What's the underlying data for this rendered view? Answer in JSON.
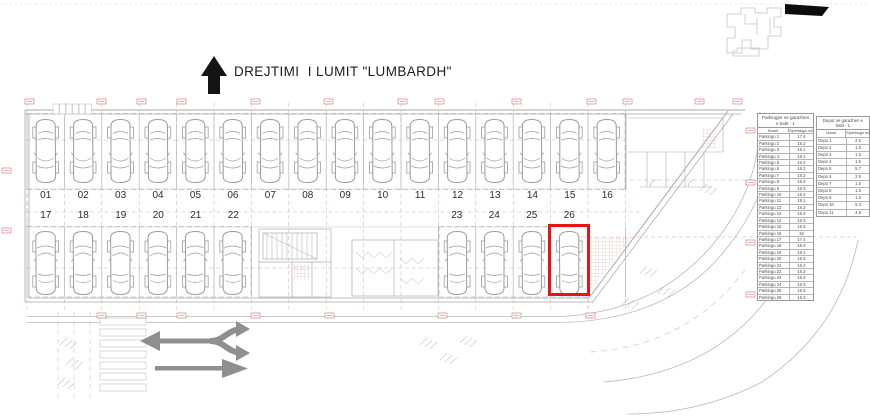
{
  "title": {
    "text": "DREJTIMI  I LUMIT \"LUMBARDH\""
  },
  "stalls": {
    "top_row": [
      "01",
      "02",
      "03",
      "04",
      "05",
      "06",
      "07",
      "08",
      "09",
      "10",
      "11",
      "12",
      "13",
      "14",
      "15",
      "16"
    ],
    "bottom_row_left": [
      "17",
      "18",
      "19",
      "20",
      "21",
      "22"
    ],
    "bottom_row_right": [
      "23",
      "24",
      "25",
      "26"
    ],
    "highlighted_stall": "26"
  },
  "parking_table": {
    "title": "Parkingjet ne garazhen e katit - 1",
    "columns": [
      "Numri",
      "Siperfaqja m2"
    ],
    "rows": [
      {
        "name": "Parkingu 1",
        "area": "17.4"
      },
      {
        "name": "Parkingu 2",
        "area": "16.3"
      },
      {
        "name": "Parkingu 3",
        "area": "19.1"
      },
      {
        "name": "Parkingu 4",
        "area": "19.1"
      },
      {
        "name": "Parkingu 5",
        "area": "16.3"
      },
      {
        "name": "Parkingu 6",
        "area": "16.3"
      },
      {
        "name": "Parkingu 7",
        "area": "16.3"
      },
      {
        "name": "Parkingu 8",
        "area": "16.3"
      },
      {
        "name": "Parkingu 9",
        "area": "16.3"
      },
      {
        "name": "Parkingu 10",
        "area": "16.3"
      },
      {
        "name": "Parkingu 11",
        "area": "19.1"
      },
      {
        "name": "Parkingu 12",
        "area": "16.3"
      },
      {
        "name": "Parkingu 13",
        "area": "16.3"
      },
      {
        "name": "Parkingu 14",
        "area": "16.3"
      },
      {
        "name": "Parkingu 15",
        "area": "16.3"
      },
      {
        "name": "Parkingu 16",
        "area": "18"
      },
      {
        "name": "Parkingu 17",
        "area": "17.4"
      },
      {
        "name": "Parkingu 18",
        "area": "16.3"
      },
      {
        "name": "Parkingu 19",
        "area": "19.1"
      },
      {
        "name": "Parkingu 20",
        "area": "16.3"
      },
      {
        "name": "Parkingu 21",
        "area": "16.3"
      },
      {
        "name": "Parkingu 22",
        "area": "16.3"
      },
      {
        "name": "Parkingu 23",
        "area": "16.3"
      },
      {
        "name": "Parkingu 24",
        "area": "16.3"
      },
      {
        "name": "Parkingu 25",
        "area": "16.3"
      },
      {
        "name": "Parkingu 26",
        "area": "16.3"
      }
    ]
  },
  "depo_table": {
    "title": "Depot ne garazhen e katit - 1",
    "columns": [
      "Numri",
      "Siperfaqja m2"
    ],
    "rows": [
      {
        "name": "Depo 1",
        "area": "2.5"
      },
      {
        "name": "Depo 2",
        "area": "1.5"
      },
      {
        "name": "Depo 3",
        "area": "1.5"
      },
      {
        "name": "Depo 4",
        "area": "1.5"
      },
      {
        "name": "Depo 5",
        "area": "5.7"
      },
      {
        "name": "Depo 6",
        "area": "2.9"
      },
      {
        "name": "Depo 7",
        "area": "1.5"
      },
      {
        "name": "Depo 8",
        "area": "1.5"
      },
      {
        "name": "Depo 9",
        "area": "1.5"
      },
      {
        "name": "Depo 10",
        "area": "5.3"
      },
      {
        "name": "Depo 11",
        "area": "4.8"
      }
    ]
  },
  "colors": {
    "highlight_red": "#e51515",
    "dimension_red": "#d46a6a",
    "cad_gray": "#a8a8a8",
    "blue_dash": "#9aa0d8",
    "arrow_gray": "#8f8f8f"
  }
}
